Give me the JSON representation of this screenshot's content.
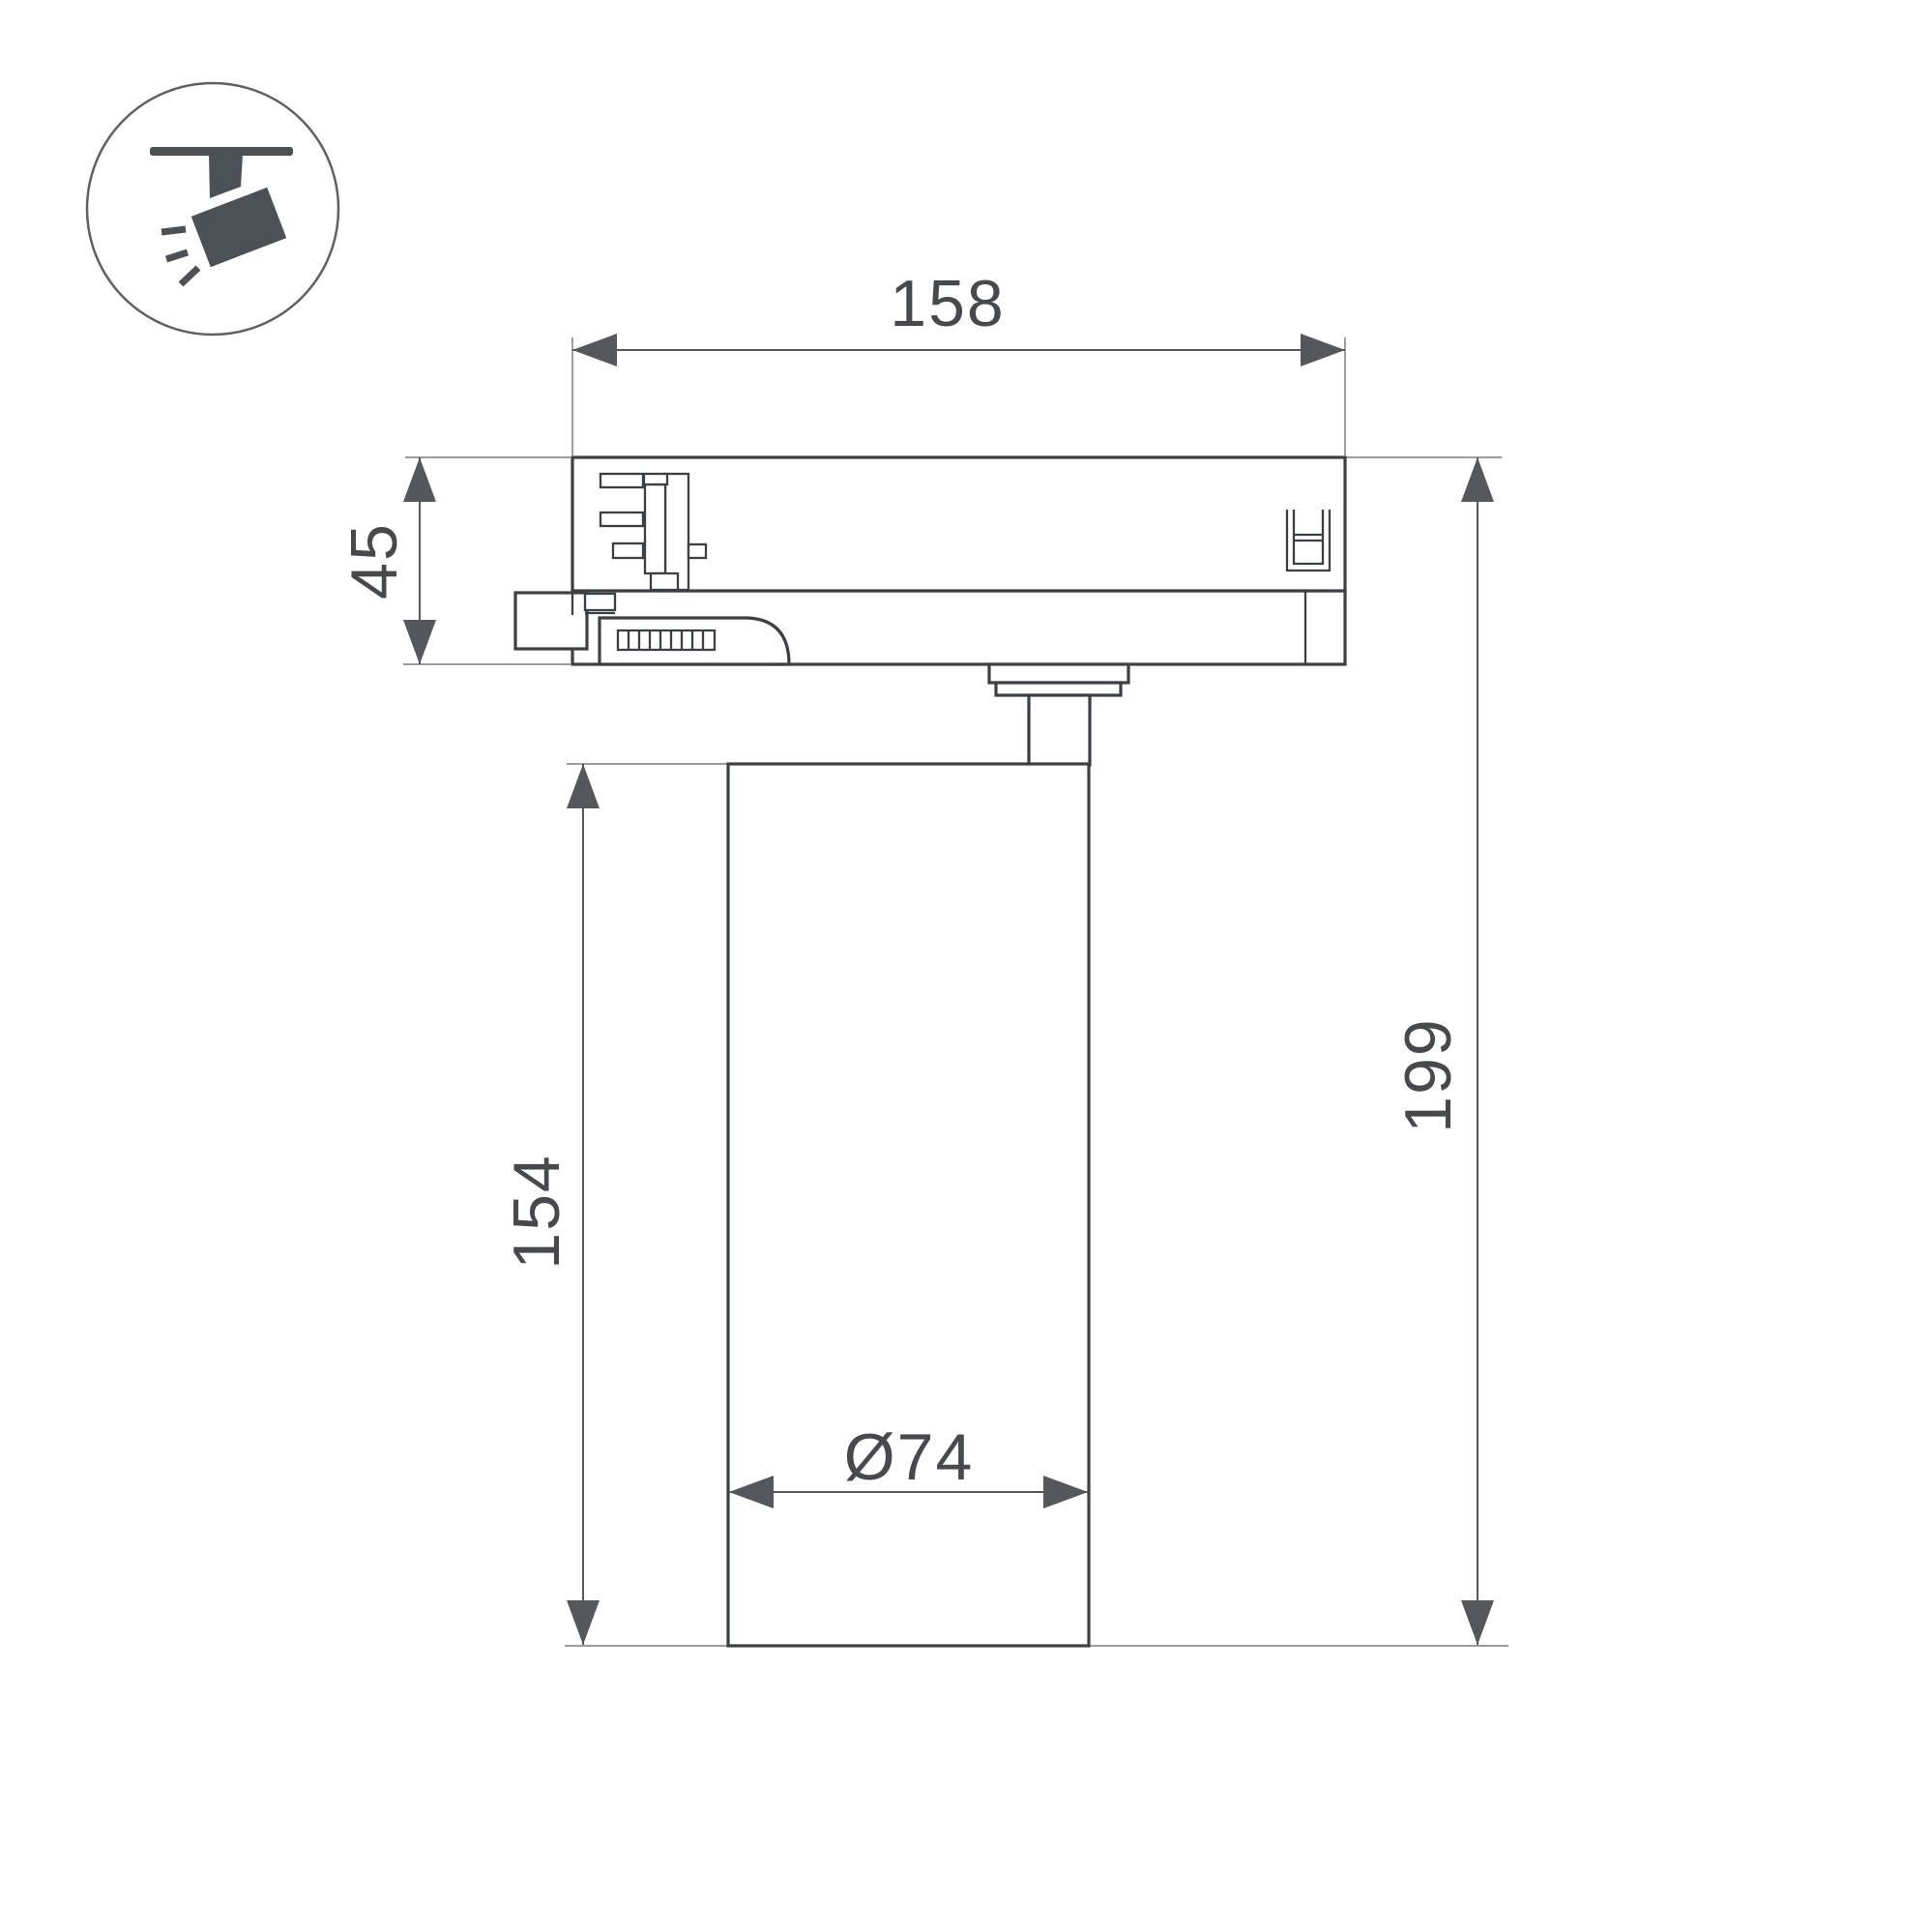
{
  "icon": {
    "label": "track-spotlight"
  },
  "drawing": {
    "dim_track_width": "158",
    "dim_adapter_height": "45",
    "dim_body_height": "154",
    "dim_total_height": "199",
    "dim_body_diameter": "Ø74"
  },
  "colors": {
    "background": "#ffffff",
    "outline": "#3b4046",
    "dimension": "#54585d",
    "extension": "#8b8f93",
    "text": "#46494e",
    "icon_fill": "#4b5157",
    "icon_ring": "#5c6165"
  }
}
